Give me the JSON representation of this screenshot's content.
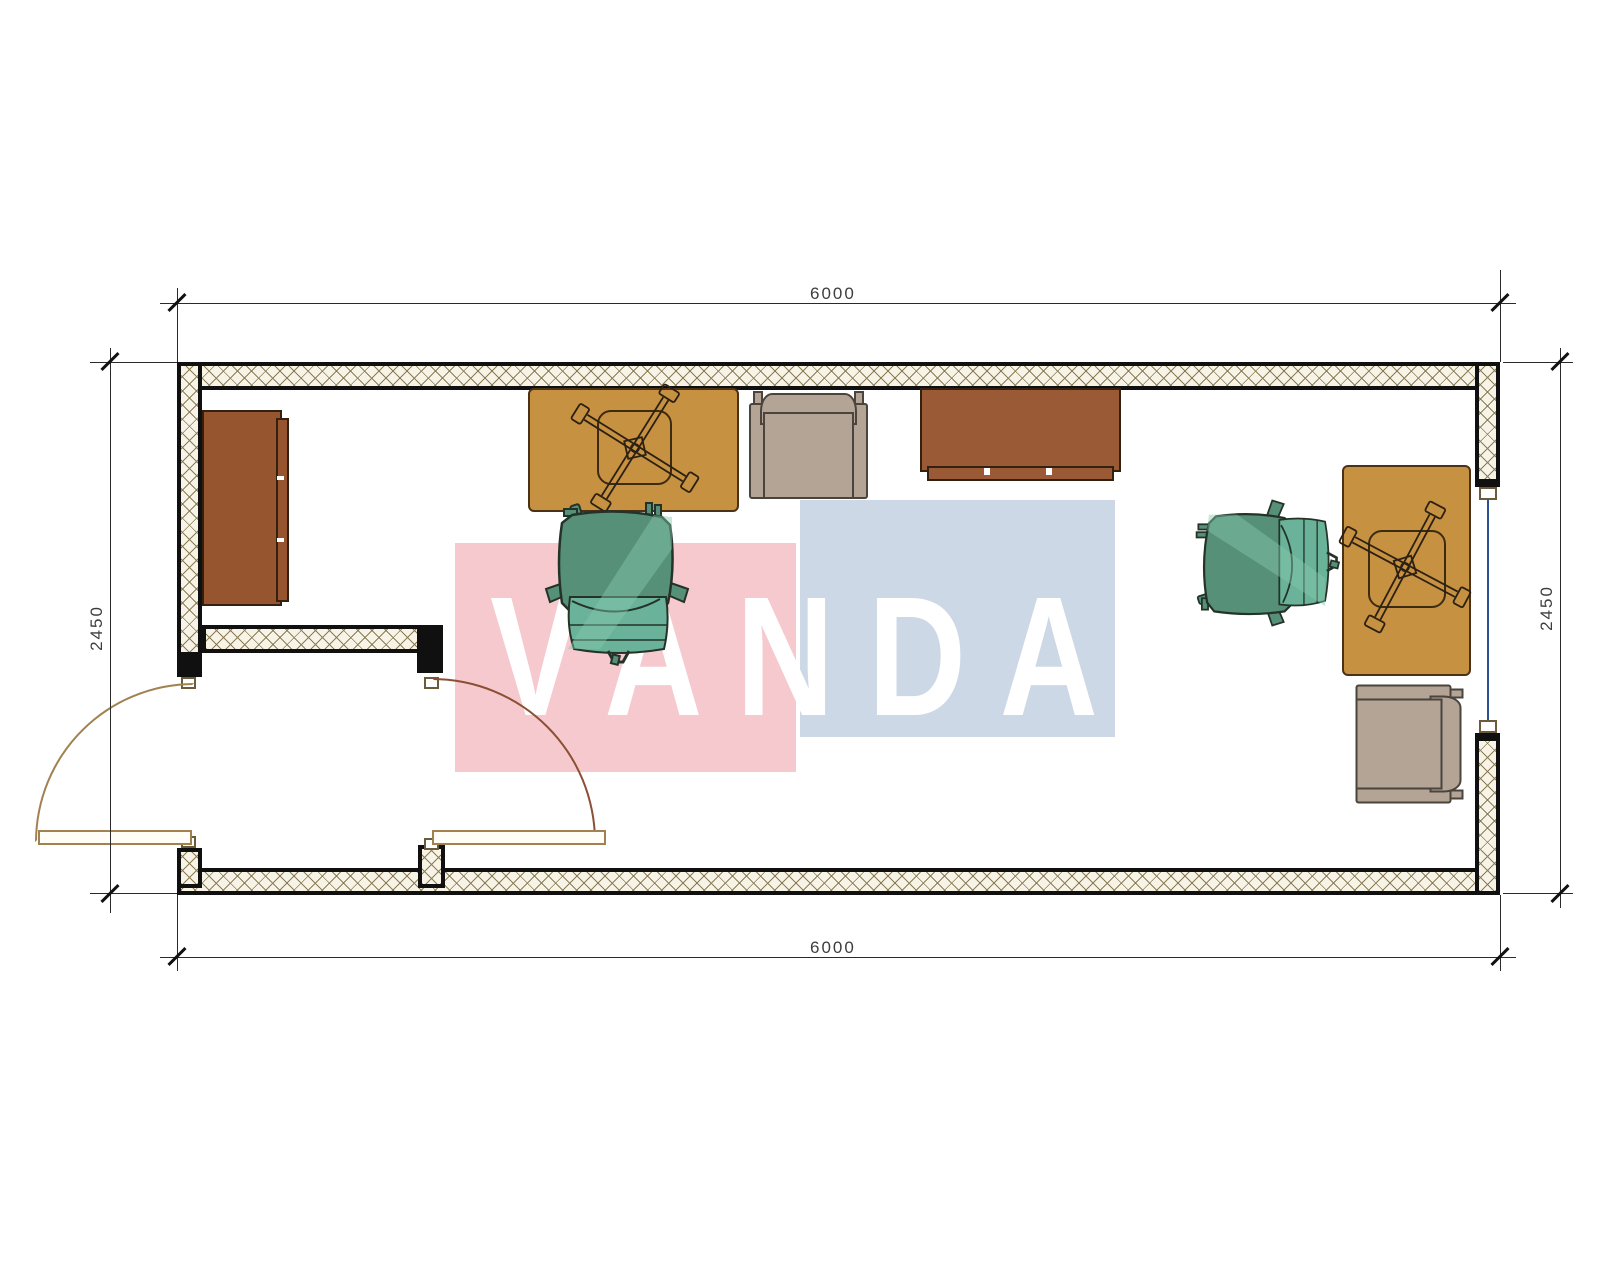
{
  "drawing": {
    "type": "floor-plan",
    "room_outer_size_mm": {
      "width": 6000,
      "depth": 2450
    }
  },
  "dimensions": {
    "top": "6000",
    "bottom": "6000",
    "left": "2450",
    "right": "2450"
  },
  "watermark": {
    "text": "VANDA",
    "pink_block_color": "#f5c9cd",
    "blue_block_color": "#cdd8e6",
    "letter_color": "#ffffff"
  },
  "colors": {
    "wall_line": "#101010",
    "hatch_bg": "#f7f3e6",
    "hatch_line": "#8a7c55",
    "desk": "#c69140",
    "cabinet": "#96552f",
    "armchair_gray": "#b3a496",
    "office_chair_green": "#5fae94",
    "window_glazing": "#2c4f96",
    "door_swing": "#a1814f",
    "dimension_text": "#3d3d3d"
  },
  "furniture": [
    {
      "name": "sideboard-left"
    },
    {
      "name": "desk-with-task-chair-base-left"
    },
    {
      "name": "armchair-top"
    },
    {
      "name": "sideboard-top"
    },
    {
      "name": "office-chair-center"
    },
    {
      "name": "office-chair-right"
    },
    {
      "name": "desk-with-task-chair-base-right"
    },
    {
      "name": "armchair-right"
    },
    {
      "name": "double-entry-door"
    },
    {
      "name": "window-right-wall"
    }
  ]
}
